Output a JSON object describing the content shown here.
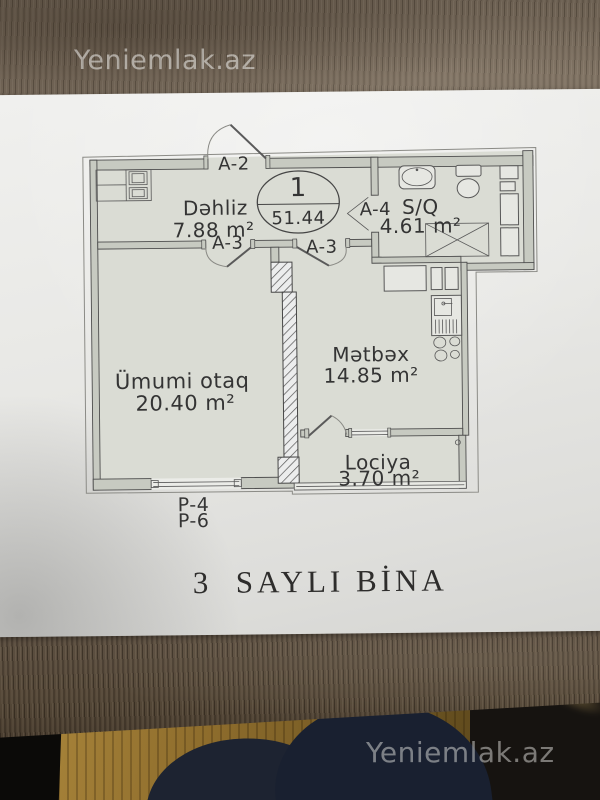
{
  "brand": {
    "watermark_top": "Yeniemlak.az",
    "watermark_bottom": "Yeniemlak.az"
  },
  "plan": {
    "unit": {
      "number": "1",
      "total_area": "51.44"
    },
    "rooms": {
      "hallway": {
        "name": "Dəhliz",
        "area": "7.88 m²"
      },
      "bathroom": {
        "name": "S/Q",
        "area": "4.61 m²"
      },
      "kitchen": {
        "name": "Mətbəx",
        "area": "14.85 m²"
      },
      "living": {
        "name": "Ümumi otaq",
        "area": "20.40 m²"
      },
      "loggia": {
        "name": "Lociya",
        "area": "3.70 m²"
      }
    },
    "doors": {
      "entrance": "A-2",
      "living_door": "A-3",
      "kitchen_door": "A-3",
      "bathroom_door": "A-4"
    },
    "windows": {
      "label_line1": "P-4",
      "label_line2": "P-6"
    },
    "building_title": "3  SAYLI BİNA"
  },
  "colors": {
    "paper": "#e9e9e6",
    "plan_floor_fill": "#dadcd4",
    "wall_fill": "#c7cac1",
    "plan_line": "#4d4d4d",
    "wood_table": "#71665a",
    "wood_floor": "#9a7a33",
    "watermark": "rgba(246,246,243,0.52)"
  }
}
